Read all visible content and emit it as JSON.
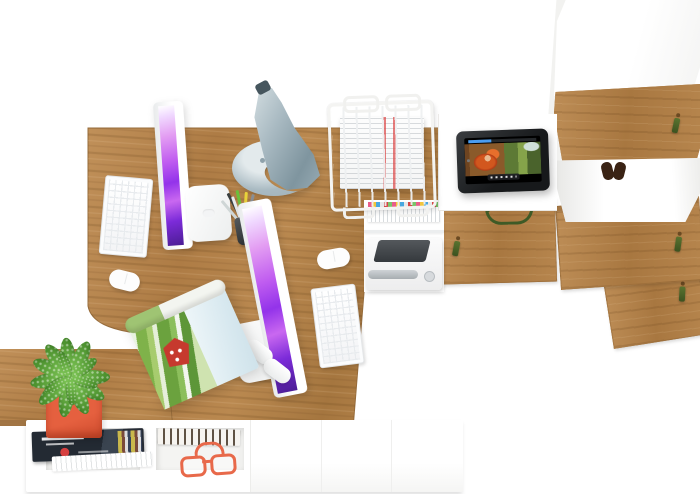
{
  "scene": {
    "description": "Top-down 3D render of a white and oak home-office furniture set with two iMac workstations",
    "view": "top-down"
  },
  "palette": {
    "background": "#ffffff",
    "wood": "#b08049",
    "wood_dark": "#8f6536",
    "white_furniture": "#ffffff",
    "lamp_gray_light": "#a9bac2",
    "lamp_gray_dark": "#7f959f",
    "screen_purple": "#9333ea",
    "screen_pink": "#e39df2",
    "pot_orange": "#e5603f",
    "plant_green": "#79c052",
    "plant_green_dark": "#4e9330",
    "key_green": "#59732f",
    "glasses_orange": "#e8694a",
    "tablet_frame": "#17191b",
    "progress_blue": "#4a9df0",
    "stripe_red": "#dc4646",
    "magazine_navy": "#232a33"
  },
  "objects": [
    "wooden-desk",
    "bench-shelf-unit",
    "imac-left",
    "imac-right",
    "keyboard-left",
    "keyboard-right",
    "mouse-left",
    "mouse-right",
    "desk-lamp",
    "pencil-cup",
    "open-magazine",
    "potted-plant",
    "wire-paper-tray",
    "tablet-playing-video",
    "printer",
    "tabbed-binders",
    "tall-cabinet",
    "cabinet-door-left",
    "cabinet-door-right",
    "cabinet-door-corner",
    "drawer-pull",
    "key-tassel",
    "magazine-stack",
    "paperback-books",
    "safety-glasses",
    "plush-toy",
    "console-top",
    "under-desk-shelf",
    "white-accessory"
  ]
}
